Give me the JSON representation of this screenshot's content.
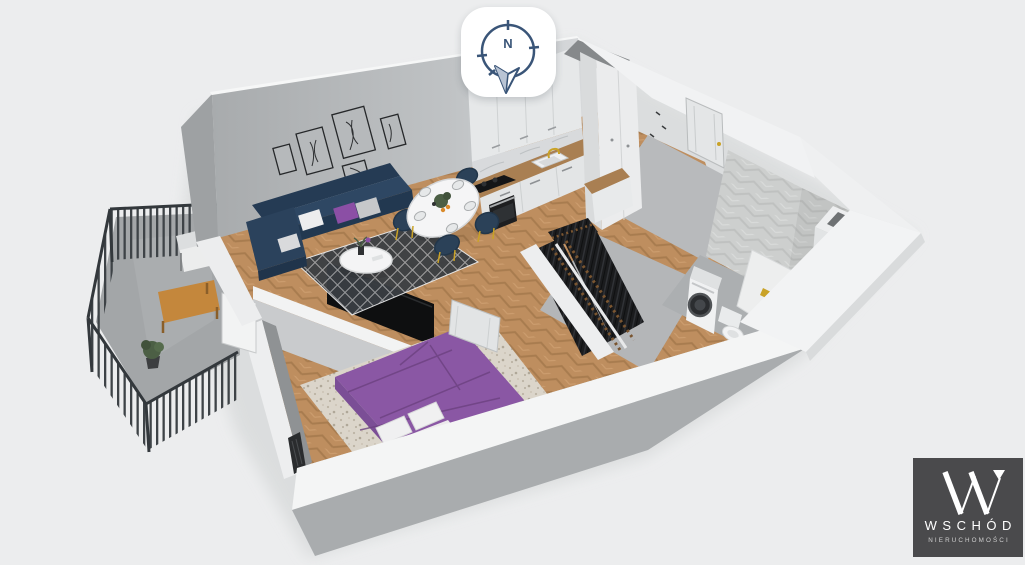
{
  "compass": {
    "icon": "compass-north-icon",
    "north_label": "N"
  },
  "logo": {
    "icon": "wschod-monogram-icon",
    "brand": "WSCHÓD",
    "subtitle": "NIERUCHOMOŚCI"
  },
  "scene": {
    "view": "3d-dollhouse-floor-plan",
    "rooms": [
      "living-room",
      "dining-area",
      "kitchen",
      "entry-hall",
      "wardrobe-hall",
      "bathroom",
      "bedroom",
      "balcony"
    ]
  },
  "colors": {
    "background": "#ECEDEE",
    "wall_top": "#F5F6F6",
    "wall_face": "#F1F2F3",
    "wall_outer": "#A9ACAE",
    "accent_wall": "#A8ABAD",
    "accent_wall_light": "#CFD1D3",
    "floor_wood": "#BE8E5F",
    "floor_gray": "#B6B8BA",
    "sofa_navy": "#2E4763",
    "sofa_navy_dark": "#223850",
    "cushion_purple": "#8B4FA5",
    "bed_purple": "#8A57A4",
    "bed_purple_dark": "#71478A",
    "rug_dark": "#3A3E43",
    "rug_light": "#DBD5CA",
    "gold": "#C9A227",
    "railing": "#3E4347",
    "wood_furniture": "#C4873C",
    "tile_gray": "#CDCFCE",
    "clothes_dark": "#1B1C1E",
    "appliance_black": "#1D1E20",
    "marble": "#D8DADC",
    "counter_wood": "#A97F52",
    "compass_navy": "#3A5578",
    "logo_bg": "#4A4A4C"
  }
}
